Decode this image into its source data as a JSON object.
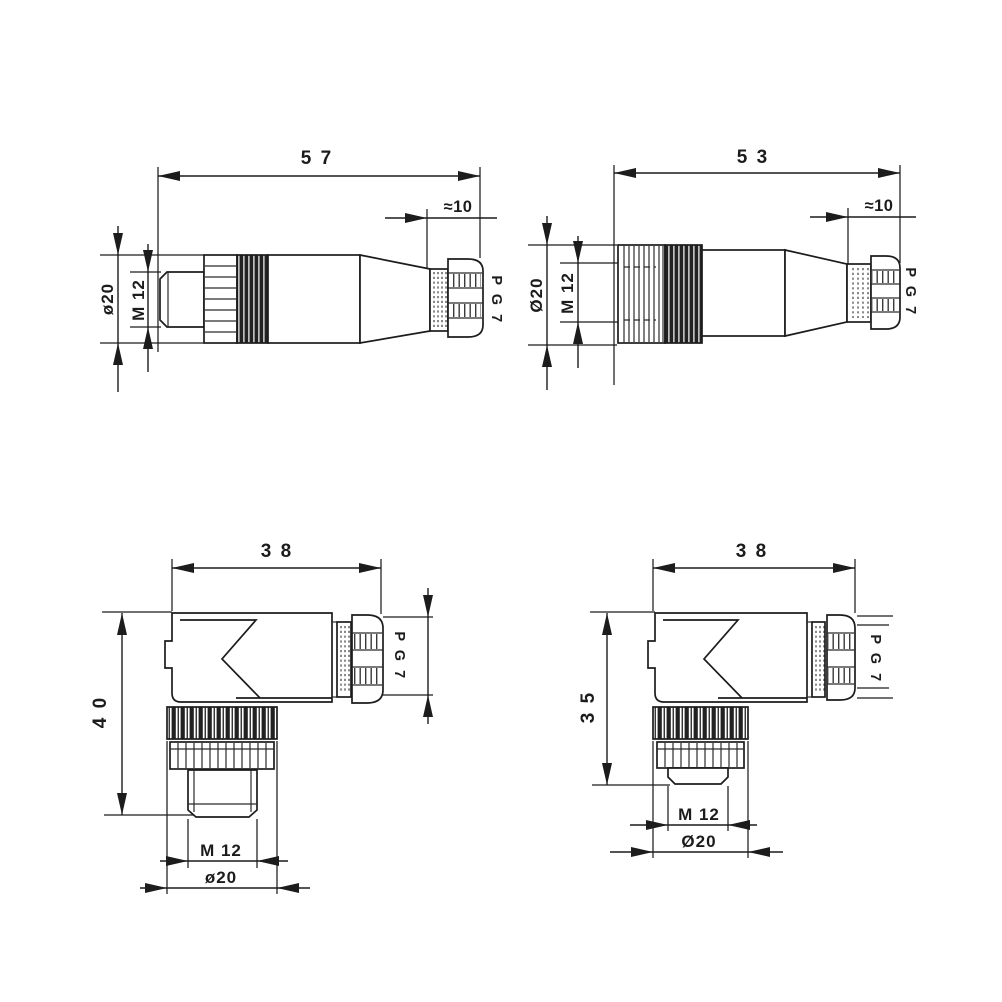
{
  "page": {
    "background": "#ffffff",
    "ink": "#1c1c1c",
    "kind": "technical-dimension-drawing"
  },
  "views": [
    {
      "id": "straight-connector-male",
      "position": "top-left",
      "labels": {
        "overall_length": "5 7",
        "gland_length": "≈10",
        "outer_diameter": "ø20",
        "mating_thread": "M 12",
        "cable_gland_thread": "P G 7"
      }
    },
    {
      "id": "straight-connector-female",
      "position": "top-right",
      "labels": {
        "overall_length": "5 3",
        "gland_length": "≈10",
        "outer_diameter": "Ø20",
        "mating_thread": "M 12",
        "cable_gland_thread": "P G 7"
      }
    },
    {
      "id": "right-angle-connector-40",
      "position": "bottom-left",
      "labels": {
        "width": "3 8",
        "height": "4 0",
        "mating_thread": "M 12",
        "outer_diameter": "ø20",
        "cable_gland_thread": "P G 7"
      }
    },
    {
      "id": "right-angle-connector-35",
      "position": "bottom-right",
      "labels": {
        "width": "3 8",
        "height": "3 5",
        "mating_thread": "M 12",
        "outer_diameter": "Ø20",
        "cable_gland_thread": "P G 7"
      }
    }
  ]
}
